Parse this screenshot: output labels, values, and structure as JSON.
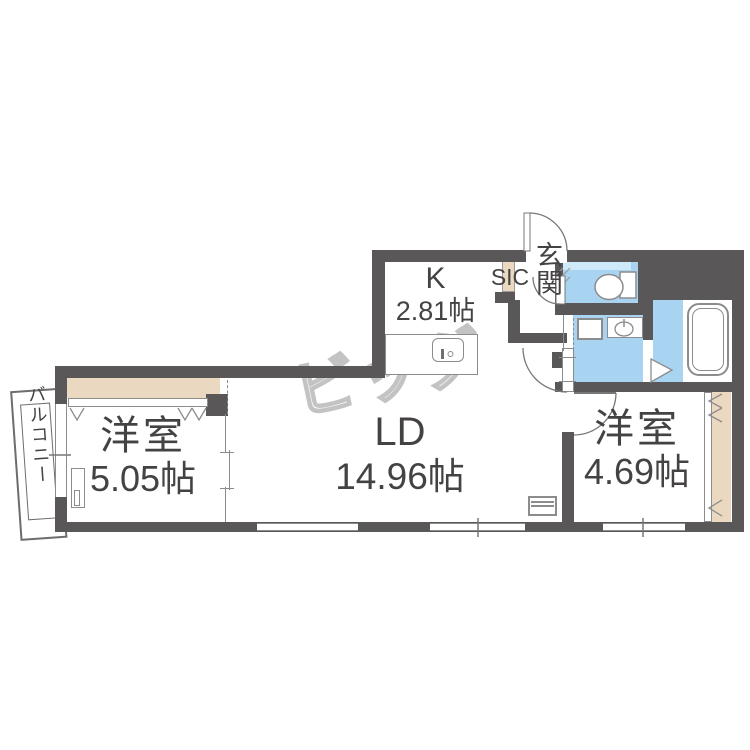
{
  "watermark": {
    "text": "ビッグ"
  },
  "rooms": {
    "living_dining": {
      "name": "LD",
      "area": "14.96帖"
    },
    "kitchen": {
      "name": "K",
      "area": "2.81帖"
    },
    "western_room_left": {
      "name": "洋室",
      "area": "5.05帖"
    },
    "western_room_right": {
      "name": "洋室",
      "area": "4.69帖"
    },
    "entrance": {
      "name": "玄関"
    },
    "shoe_closet": {
      "name": "SIC"
    },
    "balcony": {
      "name": "バルコニー"
    }
  },
  "colors": {
    "wall": "#595757",
    "wet_area": "#a8d4f2",
    "wet_area_shelf": "#cde9fa",
    "closet": "#ead8c0",
    "line": "#8c8c8c",
    "text": "#454243",
    "watermark_outline": "#c3c3c3"
  }
}
